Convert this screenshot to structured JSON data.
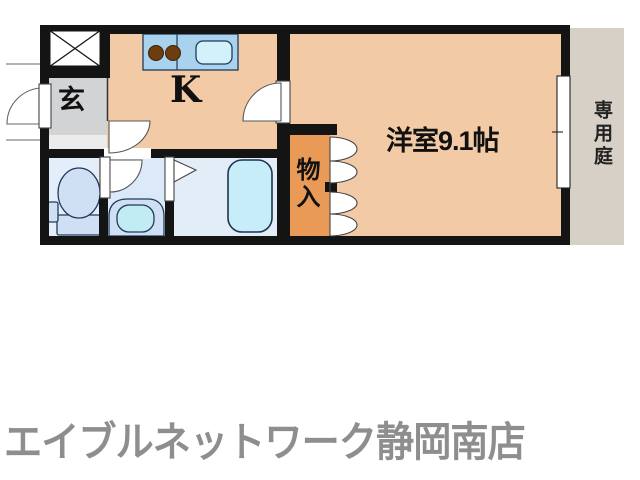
{
  "floor_plan": {
    "title": "1K apartment floor plan",
    "rooms": {
      "entrance": {
        "label": "玄"
      },
      "kitchen": {
        "label": "K"
      },
      "western_room": {
        "label": "洋室9.1帖"
      },
      "storage": {
        "label": "物入"
      },
      "private_garden": {
        "label": "専用庭"
      }
    },
    "fixtures": [
      "shoe-box-x-symbol",
      "kitchen-counter",
      "stove-burners",
      "kitchen-sink",
      "toilet",
      "washbasin-vanity",
      "bathtub",
      "closet-bifold-doors",
      "entrance-door",
      "kitchen-door",
      "room-door",
      "toilet-door",
      "bath-folding-door",
      "sliding-window"
    ],
    "colors": {
      "wall": "#141414",
      "room_floor": "#f2cba6",
      "entrance_floor": "#d2d3d5",
      "entrance_step": "#ececec",
      "toilet_floor": "#e4eefa",
      "washroom_floor": "#dbe9f8",
      "bath_floor": "#e2edf8",
      "storage_fill": "#ea9a57",
      "garden_fill": "#d6d0c6",
      "counter_fill": "#a9d2ef",
      "sink_fill": "#d2f1fb",
      "burner_fill": "#6e3d0e",
      "fixture_fill": "#cfe0f4",
      "basin_fill": "#c2ecf4",
      "tub_fill": "#c6edf8",
      "door_fill": "#ffffff"
    }
  },
  "footer": {
    "agency_name": "エイブルネットワーク静岡南店",
    "text_color": "#8e8e8e"
  }
}
